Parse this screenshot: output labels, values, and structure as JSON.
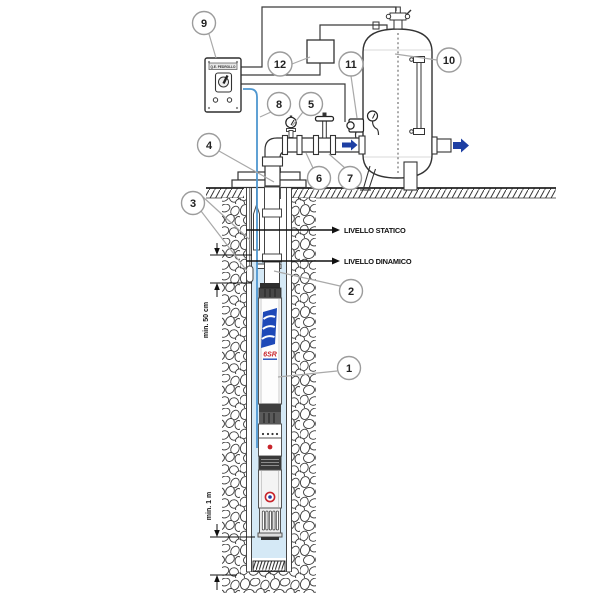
{
  "labels": {
    "static_level": "LIVELLO STATICO",
    "dynamic_level": "LIVELLO DINAMICO"
  },
  "dims": {
    "submergence": "min. 50 cm",
    "clearance": "min. 1 m"
  },
  "callouts": [
    {
      "number": "1"
    },
    {
      "number": "2"
    },
    {
      "number": "3"
    },
    {
      "number": "4"
    },
    {
      "number": "5"
    },
    {
      "number": "6"
    },
    {
      "number": "7"
    },
    {
      "number": "8"
    },
    {
      "number": "9"
    },
    {
      "number": "10"
    },
    {
      "number": "11"
    },
    {
      "number": "12"
    }
  ],
  "pump": {
    "model": "6SR"
  },
  "panel": {
    "label": "Q.E. PEDROLLO"
  },
  "colors": {
    "water": "#d5e9f6",
    "cable": "#4f97d0",
    "flow_arrow": "#1e3fa3",
    "logo_blue": "#1e49b8",
    "logo_red": "#c8242b",
    "line": "#333333",
    "leader": "#a9a9a9"
  }
}
